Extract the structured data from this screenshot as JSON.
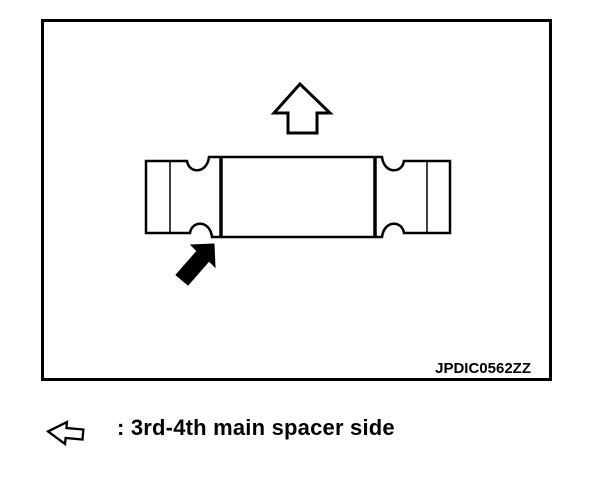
{
  "diagram": {
    "image_code": "JPDIC0562ZZ",
    "line_color": "#000000",
    "background_color": "#ffffff",
    "icons": [
      {
        "name": "up-direction-arrow-icon",
        "style": "outline",
        "direction": "up"
      },
      {
        "name": "spacer-side-pointer-icon",
        "style": "filled",
        "direction": "up-right"
      }
    ],
    "subject": "spacer-part-side-view"
  },
  "legend": {
    "icon": "left-arrow-icon",
    "text": ": 3rd-4th main spacer side"
  }
}
